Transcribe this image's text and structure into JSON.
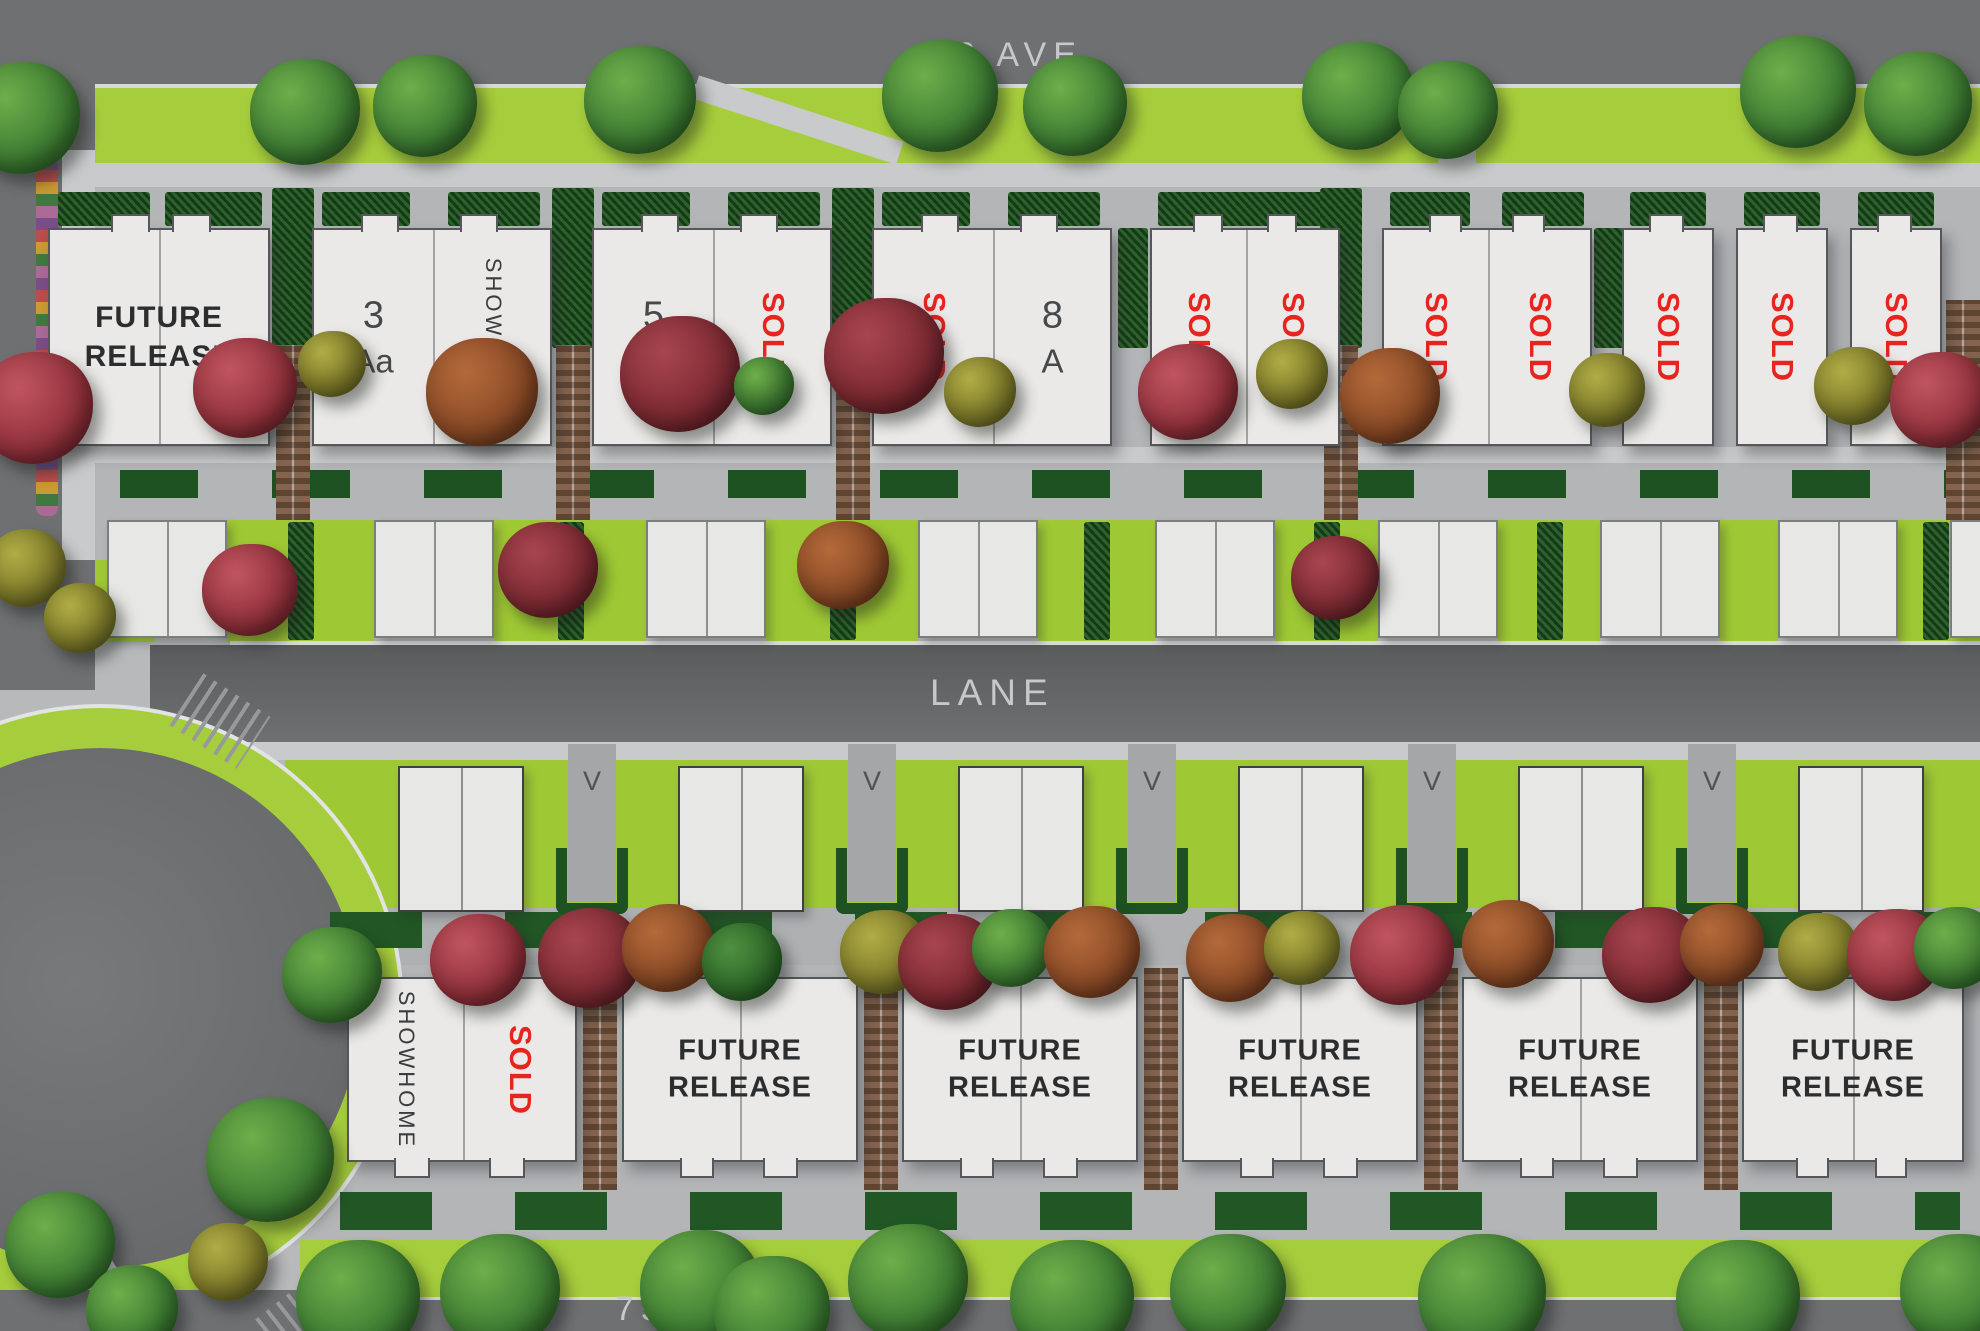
{
  "streets": {
    "top": "76 AVE",
    "lane": "LANE",
    "bottom": "75B AVE"
  },
  "compass": {
    "north": "N"
  },
  "top_row": {
    "b1": {
      "label": "FUTURE RELEASE"
    },
    "b2": {
      "u1_number": "3",
      "u1_type": "Aa",
      "u2": "SHOWHOME"
    },
    "b3": {
      "u1_number": "5",
      "u1_type": "Aa",
      "u2": "SOLD"
    },
    "b4": {
      "u1": "SOLD",
      "u2_number": "8",
      "u2_type": "A"
    },
    "b5": {
      "u1": "SOLD",
      "u2": "SOLD"
    },
    "b6": {
      "u1": "SOLD",
      "u2": "SOLD"
    },
    "b7": {
      "u1": "SOLD"
    },
    "b8": {
      "u1": "SOLD"
    },
    "b9": {
      "u1": "SOLD"
    }
  },
  "bottom_row": {
    "s1": {
      "u1": "SHOWHOME",
      "u2": "SOLD"
    },
    "f1": {
      "label": "FUTURE RELEASE"
    },
    "f2": {
      "label": "FUTURE RELEASE"
    },
    "f3": {
      "label": "FUTURE RELEASE"
    },
    "f4": {
      "label": "FUTURE RELEASE"
    },
    "f5": {
      "label": "FUTURE RELEASE"
    }
  },
  "visitor_stalls": {
    "v1": "V",
    "v2": "V",
    "v3": "V",
    "v4": "V",
    "v5": "V"
  },
  "colors": {
    "sold_red": "#e8241f",
    "lime_green": "#a6ce3c",
    "road_grey": "#6e7072",
    "building_fill": "#eae9e7",
    "hedge_green": "#1e5122",
    "brick_brown": "#7a5740"
  }
}
